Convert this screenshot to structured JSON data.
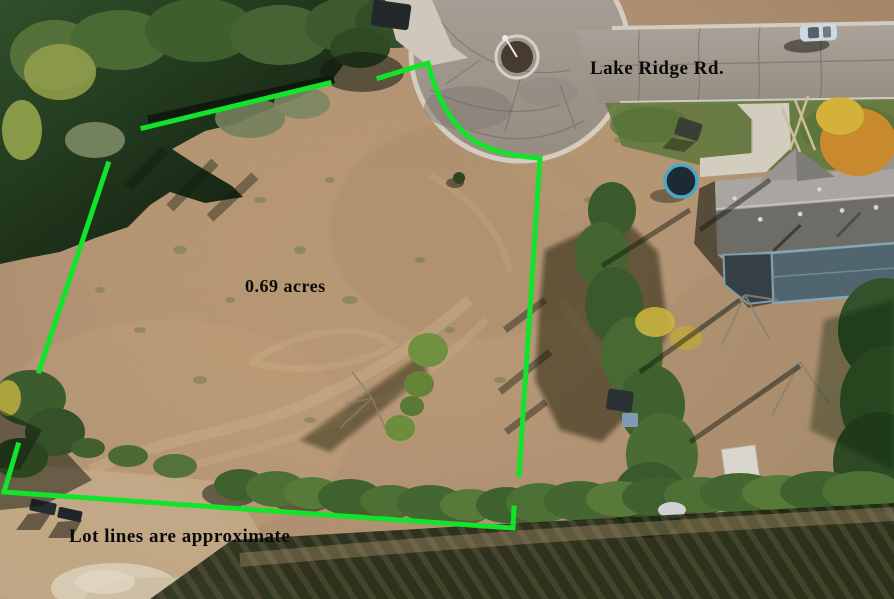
{
  "scene": {
    "type": "aerial-lot-photo",
    "labels": {
      "road": "Lake Ridge Rd.",
      "area": "0.69 acres",
      "disclaimer": "Lot lines are approximate"
    },
    "colors": {
      "lot_line": "#12e42c",
      "label_text": "#0a0a0a",
      "field": "#b29270",
      "road_pavement": "#a39a8f",
      "curb": "#d2ccc1",
      "tree_canopy": "#3f612e",
      "roof_north_slope": "#a9a6a1",
      "roof_south_slope": "#6e6c67",
      "deck_trim": "#84a7b6",
      "trampoline_ring": "#4aa7c8"
    },
    "lot_lines": {
      "stroke_width": "5",
      "segments": [
        {
          "id": "northwest-diagonal",
          "points": "143,128 329,83"
        },
        {
          "id": "west-upper",
          "points": "108,164 39,371"
        },
        {
          "id": "west-lower",
          "points": "18,445 4,492"
        },
        {
          "id": "south-with-hook",
          "points": "4,492 513,528 514,508"
        },
        {
          "id": "east",
          "points": "519,475 540,158"
        }
      ],
      "north_cul_de_sac_curve": "M 379,78 L 428,63 C 434,88 444,112 462,131 C 480,149 508,156 540,158"
    }
  }
}
